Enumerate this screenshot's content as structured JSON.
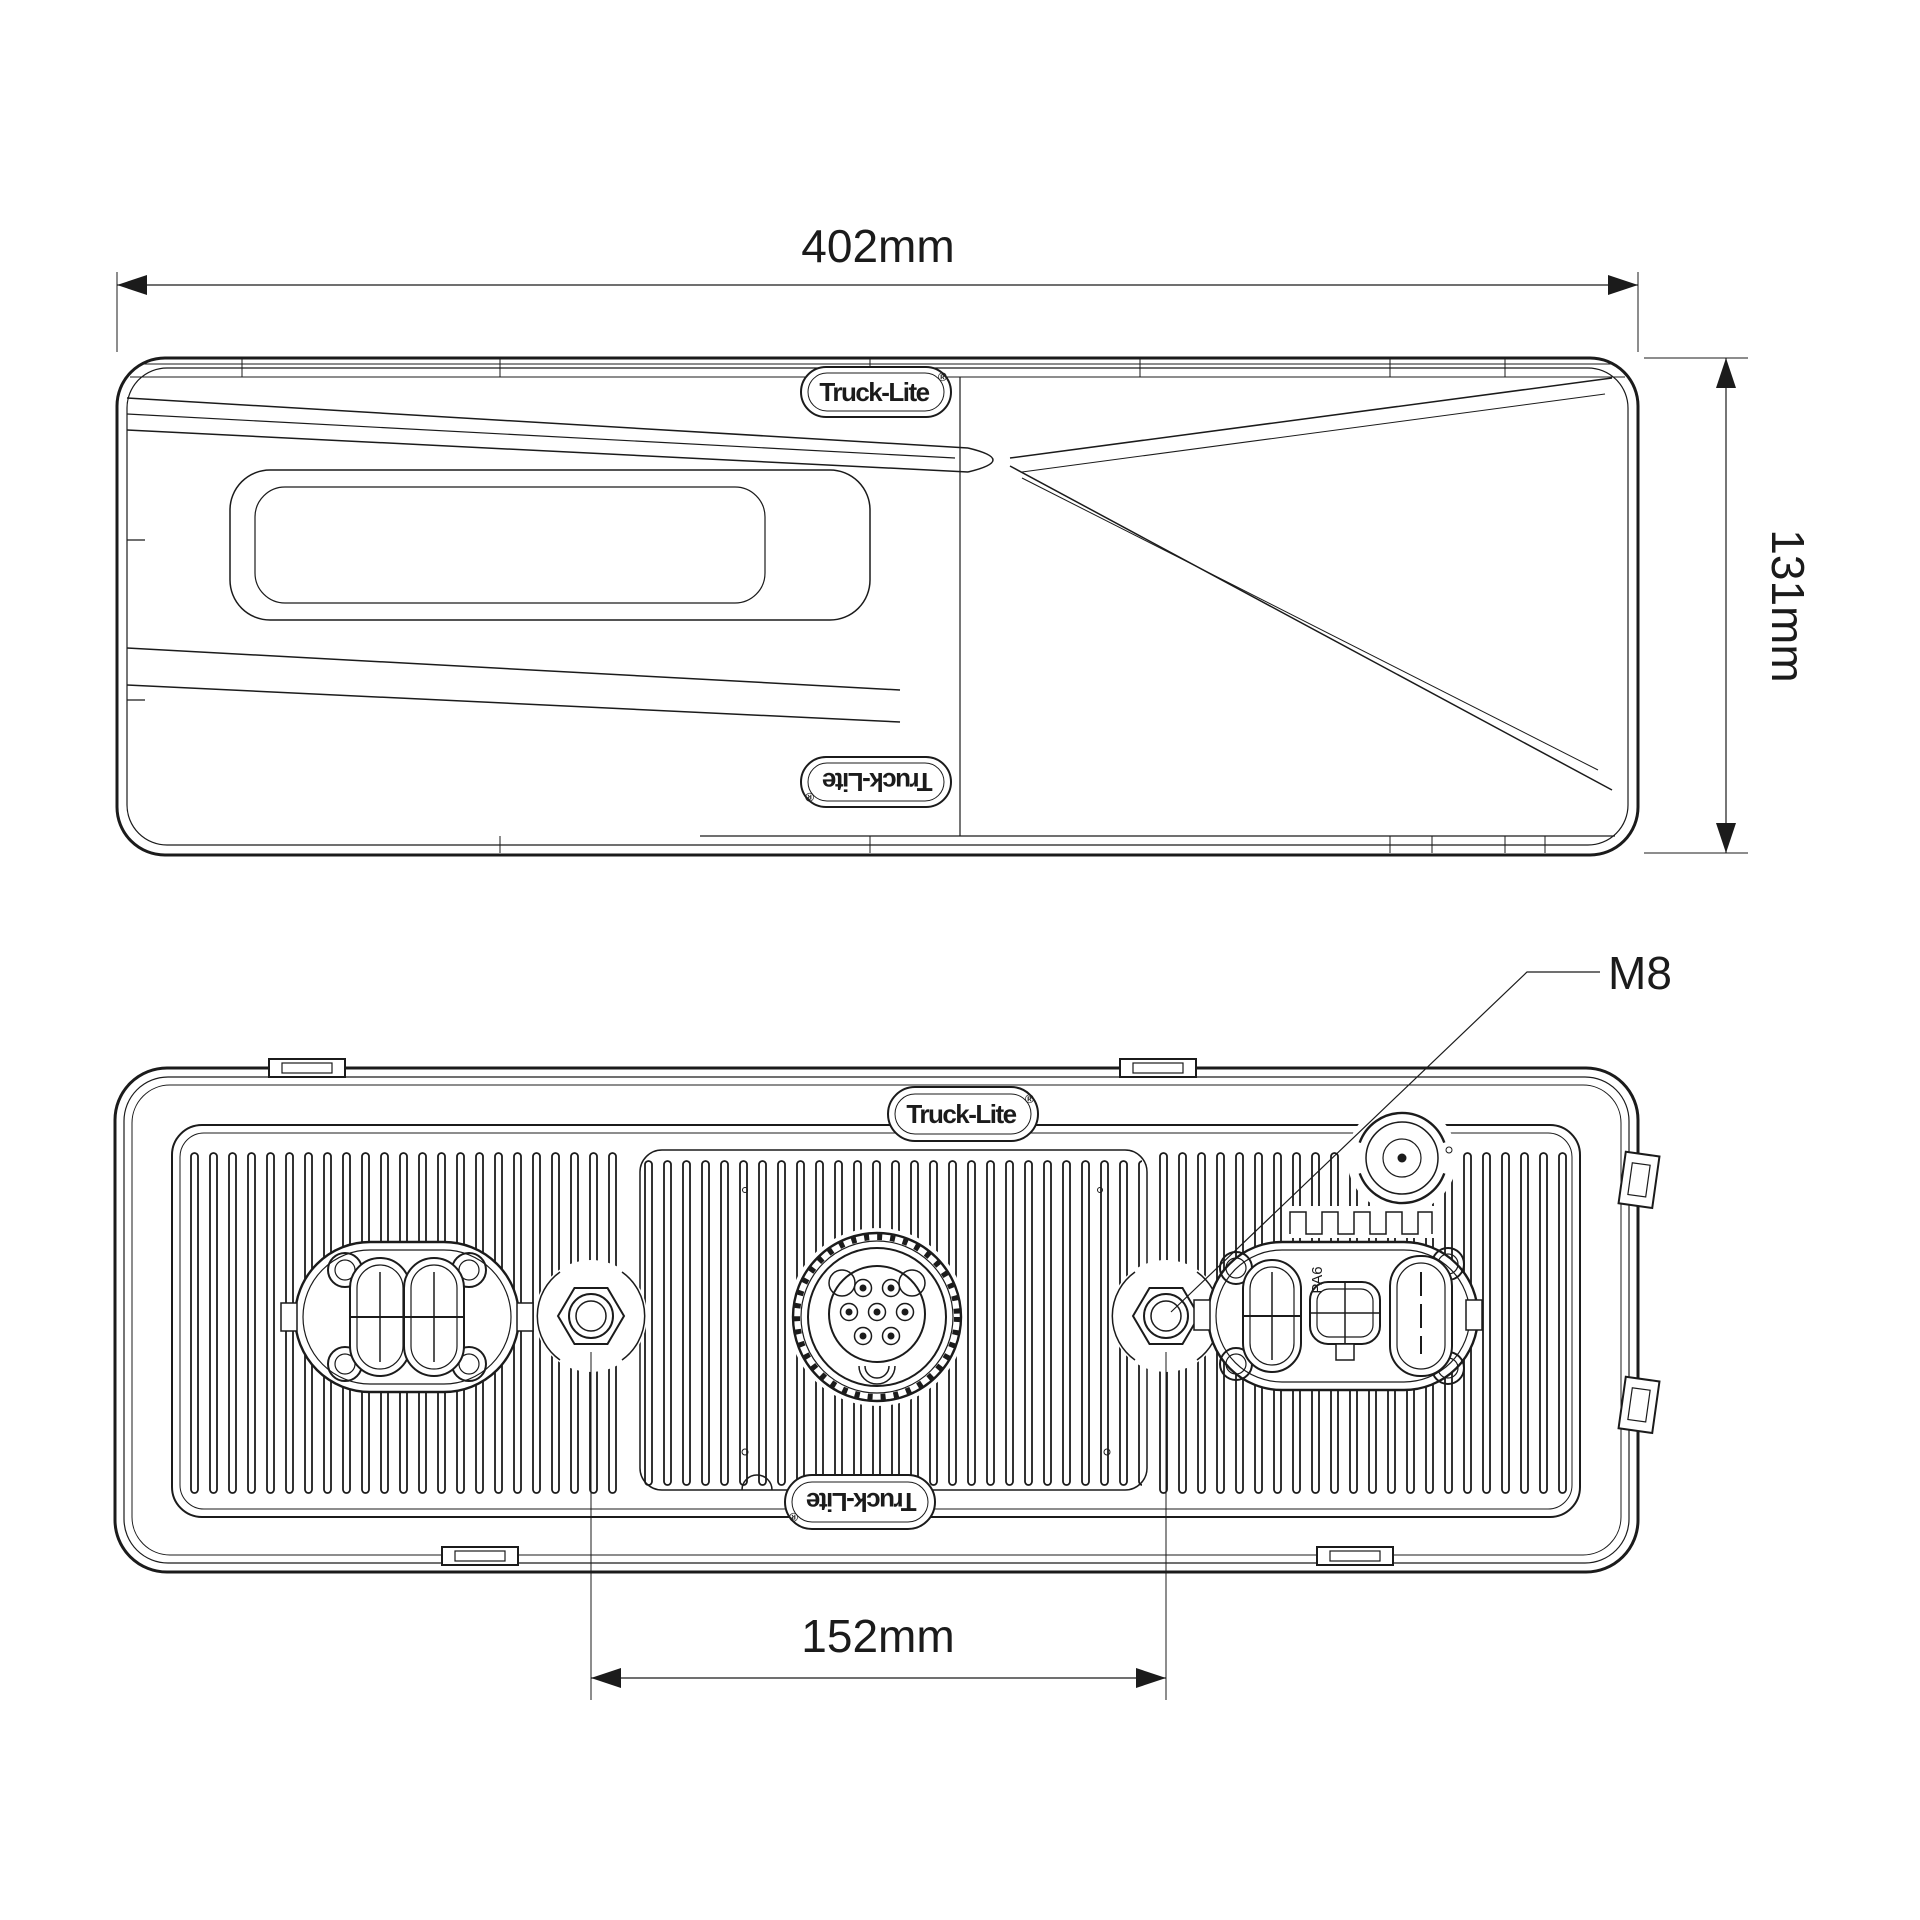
{
  "colors": {
    "line": "#1b1b1b",
    "background": "#ffffff"
  },
  "logo": {
    "text": "Truck-Lite",
    "reg": "®"
  },
  "top_view": {
    "width_dimension": {
      "label": "402mm"
    },
    "height_dimension": {
      "label": "131mm"
    }
  },
  "rear_view": {
    "stud_spacing_dimension": {
      "label": "152mm"
    },
    "stud_thread_label": "M8",
    "material_marking": "PA6"
  }
}
